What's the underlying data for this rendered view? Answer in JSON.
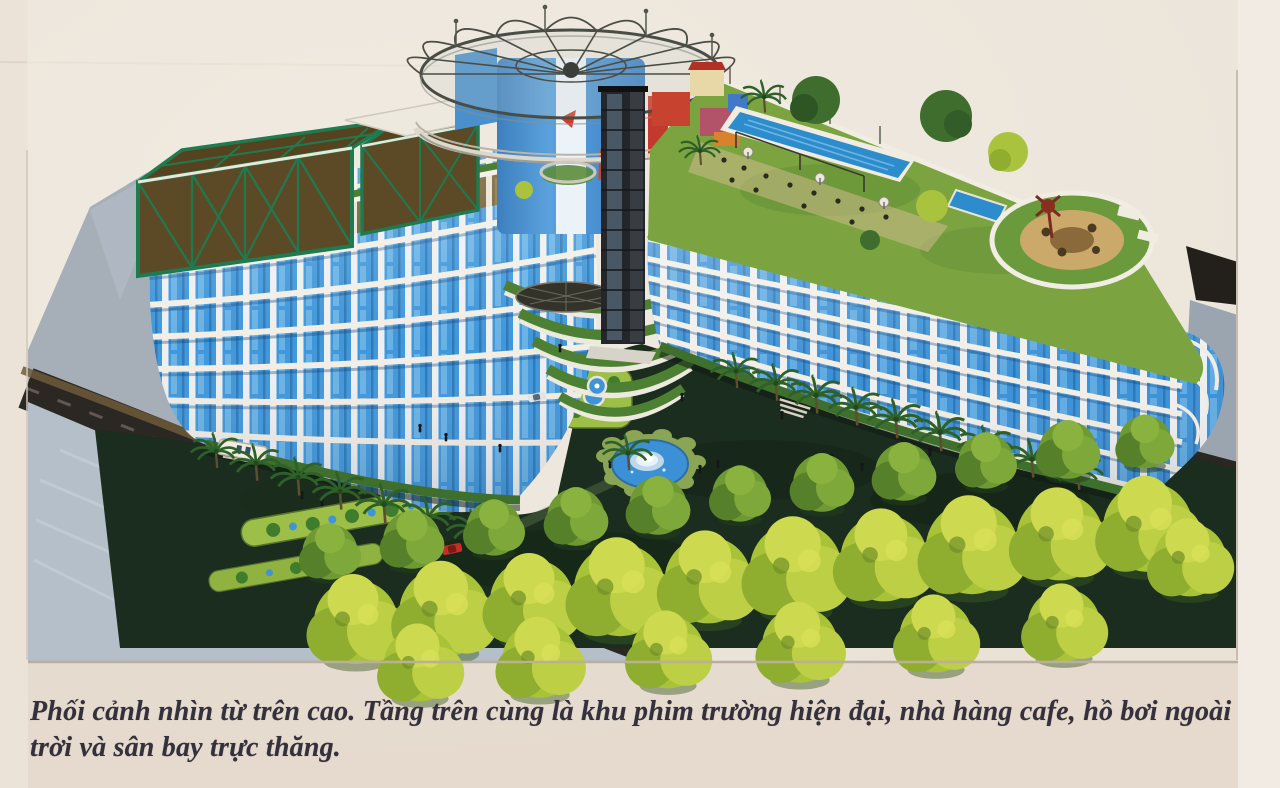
{
  "figure": {
    "name": "aerial-perspective-rendering",
    "description": "Phối cảnh nhìn từ trên cao: khách sạn hai cánh hình chữ V với các dải tầng trắng và kính xanh, tháp tròn xanh có mái thép hình quạt ở giữa, khu phim trường khung thép xanh lá trên mái cánh trái, hồ bơi dài, nhà hàng cafe và vườn tròn trực thăng trên mái cánh phải, đài phun nước, thảm cỏ, hàng cây và đường vòng phía trước.",
    "labels": {
      "film_studio": "khu phim trường hiện đại (khung thép xanh)",
      "cafe_restaurant": "nhà hàng cafe trên mái",
      "rooftop_pool": "hồ bơi ngoài trời",
      "helipad_garden": "sân bay trực thăng (vườn tròn)",
      "central_tower": "tháp tròn với mái thép hình quạt",
      "elevator_shaft": "lồng thang máy kính",
      "fountain": "đài phun nước",
      "courtyard_lawn": "sân trong và thảm cỏ",
      "tree_rows": "hàng cây xanh phía trước",
      "ring_road": "đường vòng và quảng trường"
    }
  },
  "caption": {
    "line1": "Phối cảnh nhìn từ trên cao. Tầng trên cùng là khu phim trường hiện đại, nhà hàng cafe, hồ bơi ngoài",
    "line2": "trời và sân bay trực thăng."
  },
  "palette": {
    "paper": "#e9dfd4",
    "facade_white": "#f2eee6",
    "glass_blue": "#3f97db",
    "glass_brown": "#6d5827",
    "truss_green": "#1f7a50",
    "lawn_dark": "#1b2d1e",
    "hedge_light": "#9dbf48",
    "tree_yellow_green": "#b9cf42",
    "pool_blue": "#2d8ccb",
    "road_dark": "#2b2722",
    "plaza_gray": "#a6aeb8",
    "water_gray": "#b4bfc9",
    "tower_blue": "#4e9bd8",
    "accent_red": "#c23a2e"
  }
}
